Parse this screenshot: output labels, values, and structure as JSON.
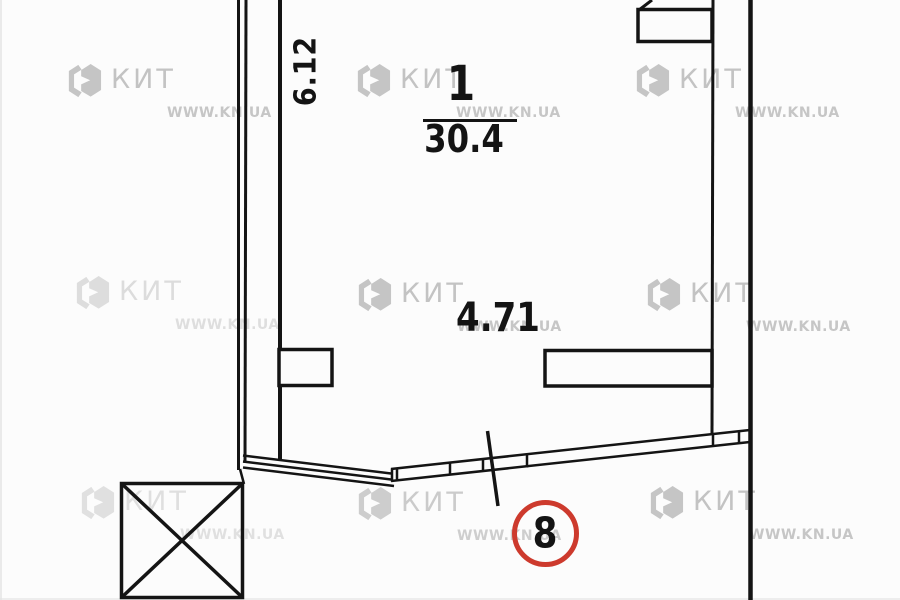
{
  "plan": {
    "room_number": "1",
    "room_area": "30.4",
    "length_dimension": "6.12",
    "width_dimension": "4.71",
    "section_marker": "8"
  },
  "watermark": {
    "brand": "КИТ",
    "site": "WWW.KN.UA",
    "logo_icon": "kit-hexagon-logo"
  },
  "colors": {
    "line": "#141414",
    "marker_red": "#cd3a2d",
    "watermark_gray": "#c5c5c5",
    "background": "#fcfcfc"
  }
}
